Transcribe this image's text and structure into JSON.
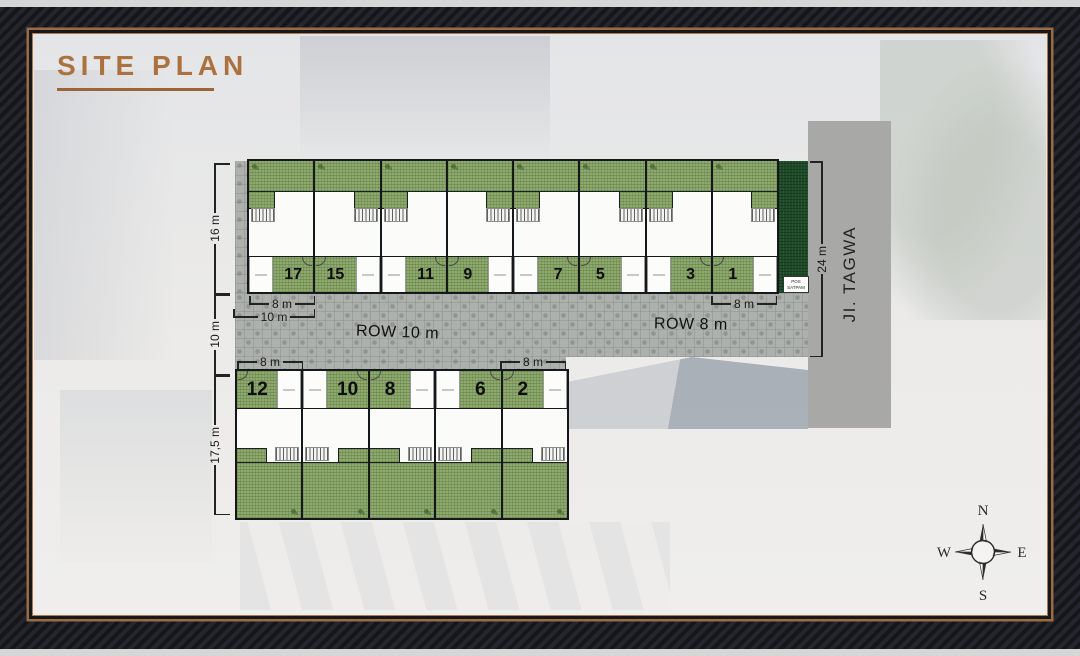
{
  "title": "SITE PLAN",
  "plan": {
    "rows": {
      "top": {
        "units": [
          "17",
          "15",
          "11",
          "9",
          "7",
          "5",
          "3",
          "1"
        ]
      },
      "bottom": {
        "units": [
          "12",
          "10",
          "8",
          "6",
          "2"
        ]
      }
    },
    "dimensions": {
      "row_top_height": "16 m",
      "road_width": "10 m",
      "row_bottom_height": "17,5 m",
      "street_frontage": "24 m",
      "lot_width_top_left": "8 m",
      "lot_depth_top_left": "10 m",
      "lot_width_top_right": "8 m",
      "lot_width_bottom_left": "8 m",
      "lot_width_bottom_right": "8 m"
    },
    "roads": {
      "row_10": "ROW 10 m",
      "row_8": "ROW 8 m",
      "street": "JI. TAGWA"
    },
    "guard_post": {
      "line1": "POS",
      "line2": "SATPAM"
    },
    "compass": {
      "north": "N",
      "east": "E",
      "south": "S",
      "west": "W"
    }
  },
  "colors": {
    "accent": "#ab723f",
    "garden": "#8ea96e",
    "hedge": "#1d4b28",
    "paver": "#adb1ae",
    "street": "#a8a9a7",
    "frame": "#16181c"
  }
}
